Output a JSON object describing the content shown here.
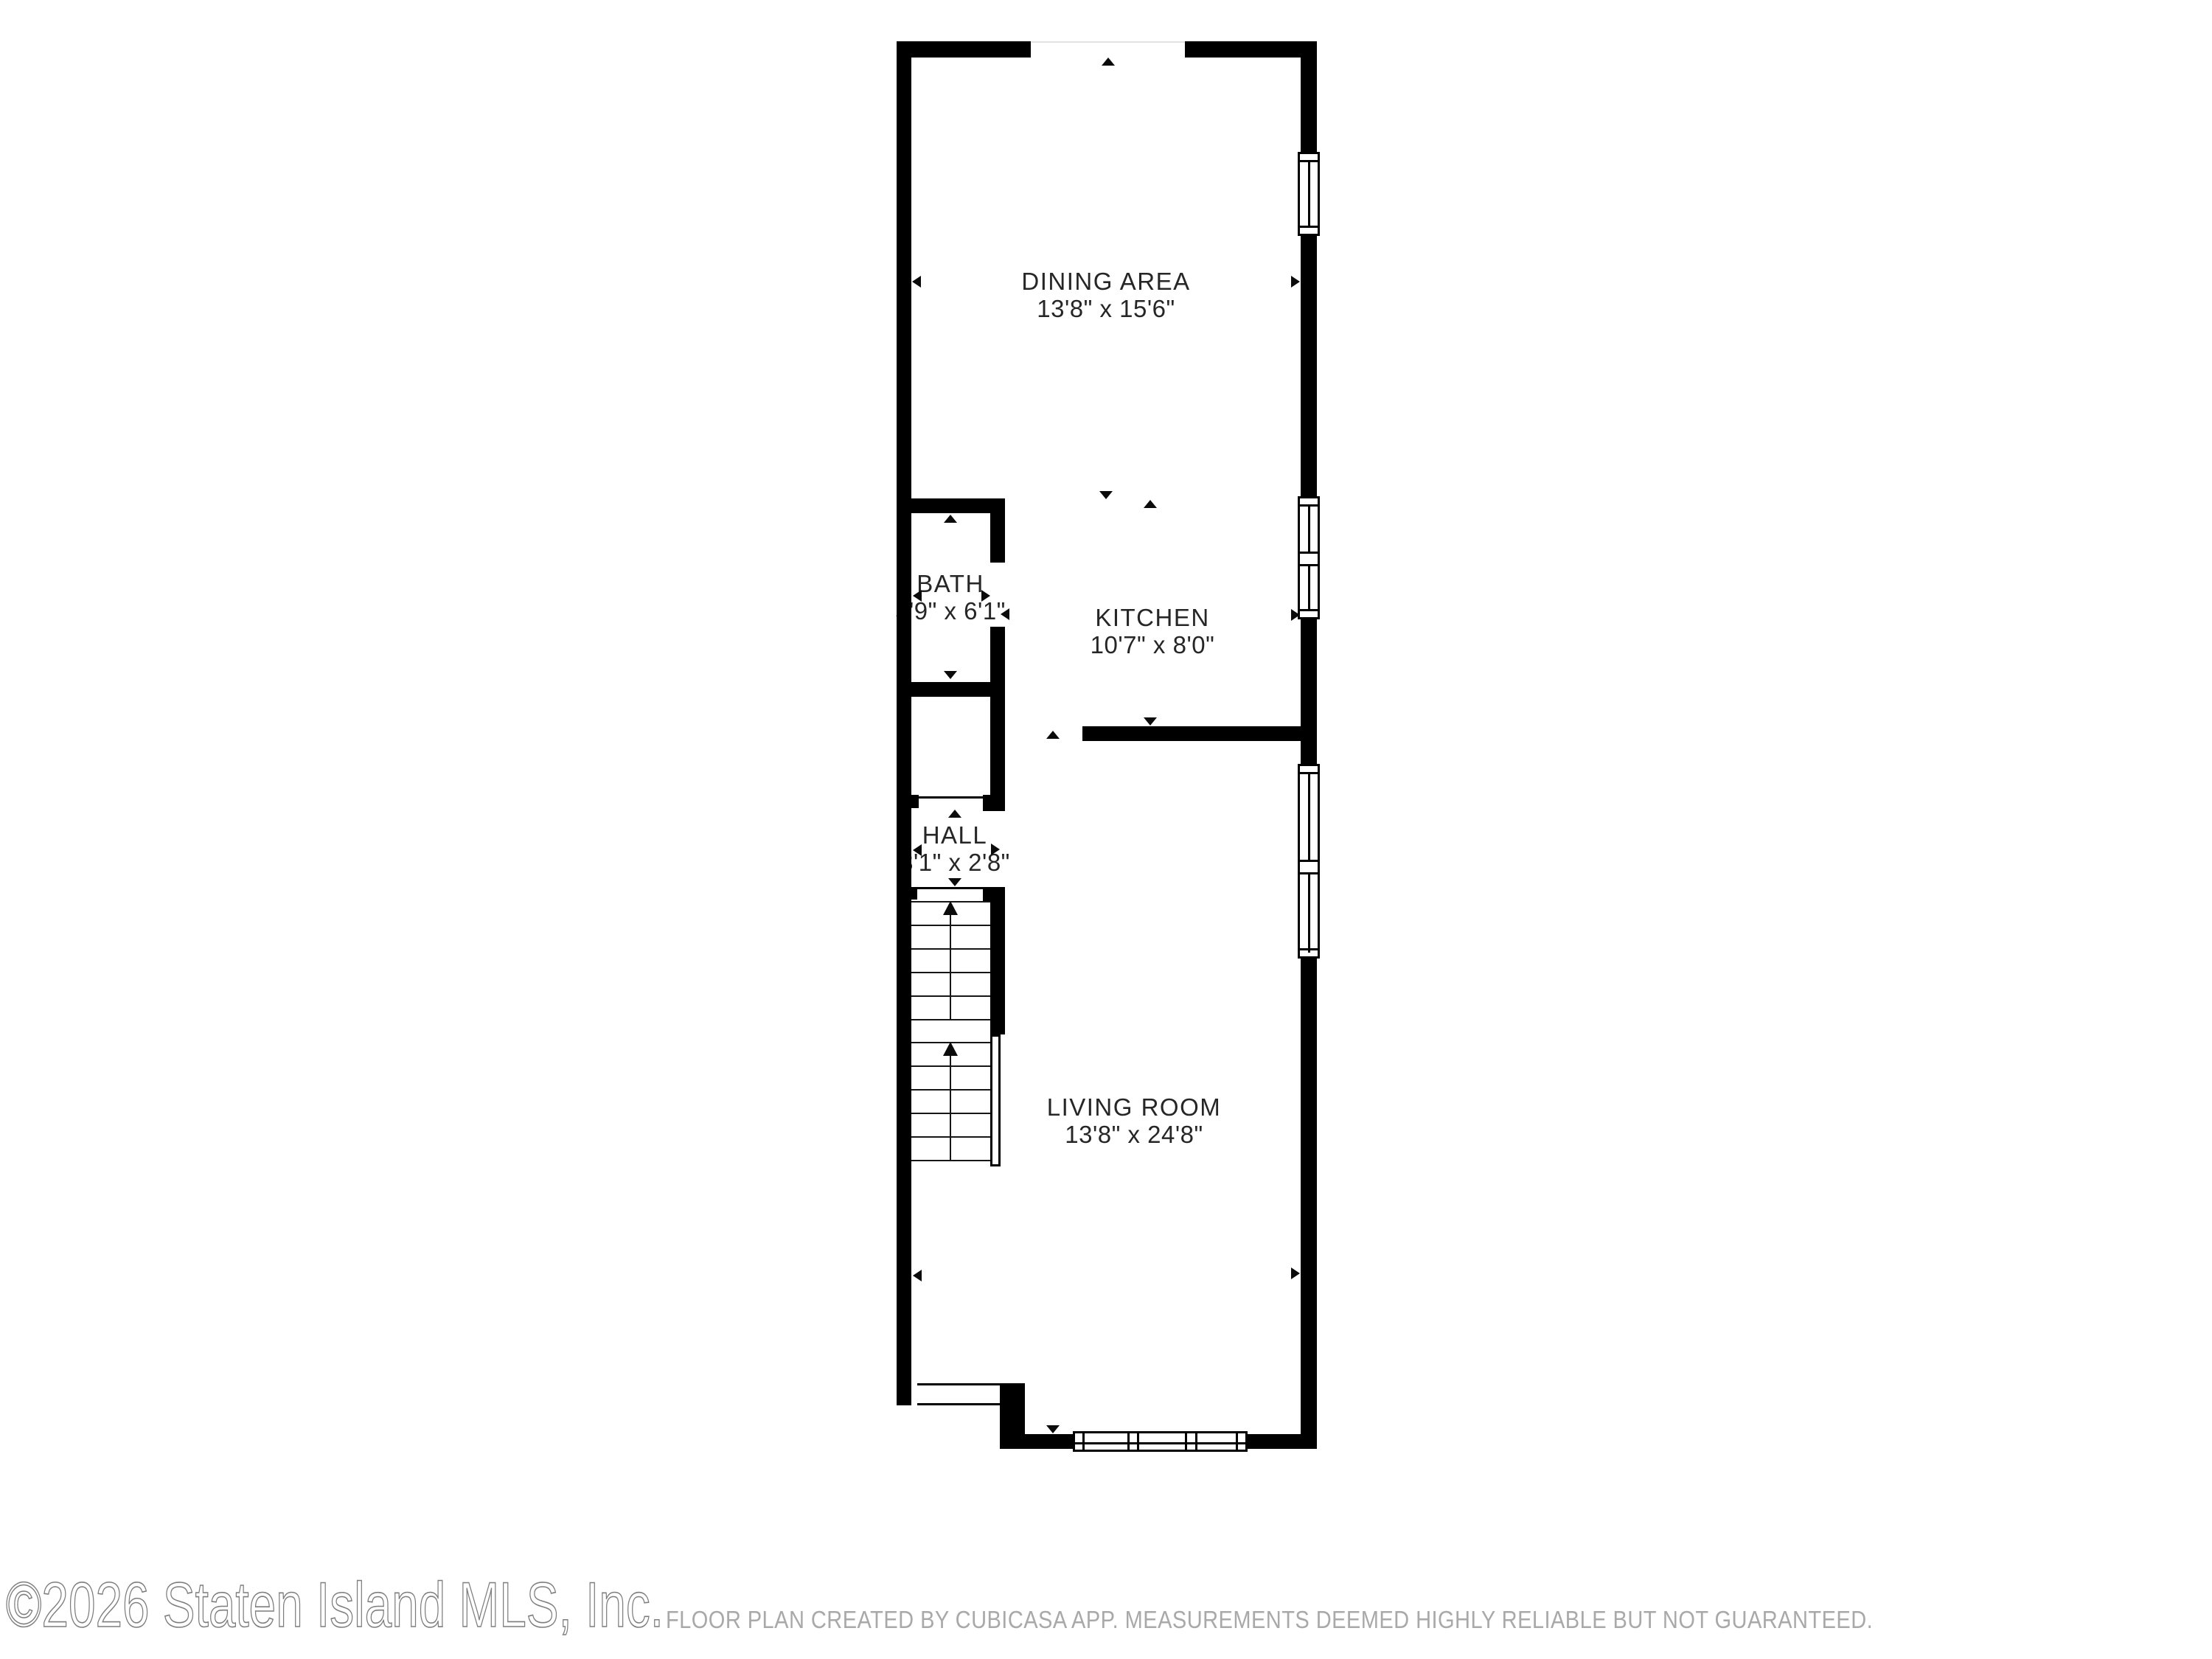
{
  "rooms": {
    "dining": {
      "name": "DINING AREA",
      "dims": "13'8\" x 15'6\""
    },
    "bath": {
      "name": "BATH",
      "dims": "5'9\" x 6'1\""
    },
    "kitchen": {
      "name": "KITCHEN",
      "dims": "10'7\" x 8'0\""
    },
    "hall": {
      "name": "HALL",
      "dims": "3'1\" x 2'8\""
    },
    "living": {
      "name": "LIVING ROOM",
      "dims": "13'8\" x 24'8\""
    }
  },
  "watermark": "©2026 Staten Island MLS, Inc.",
  "footer": "FLOOR PLAN CREATED BY CUBICASA APP. MEASUREMENTS DEEMED HIGHLY RELIABLE BUT NOT GUARANTEED.",
  "colors": {
    "wall": "#000000",
    "label_text": "#262626",
    "footer_text": "#a9a9a9",
    "watermark_stroke": "#7d7d7d",
    "background": "#ffffff"
  }
}
